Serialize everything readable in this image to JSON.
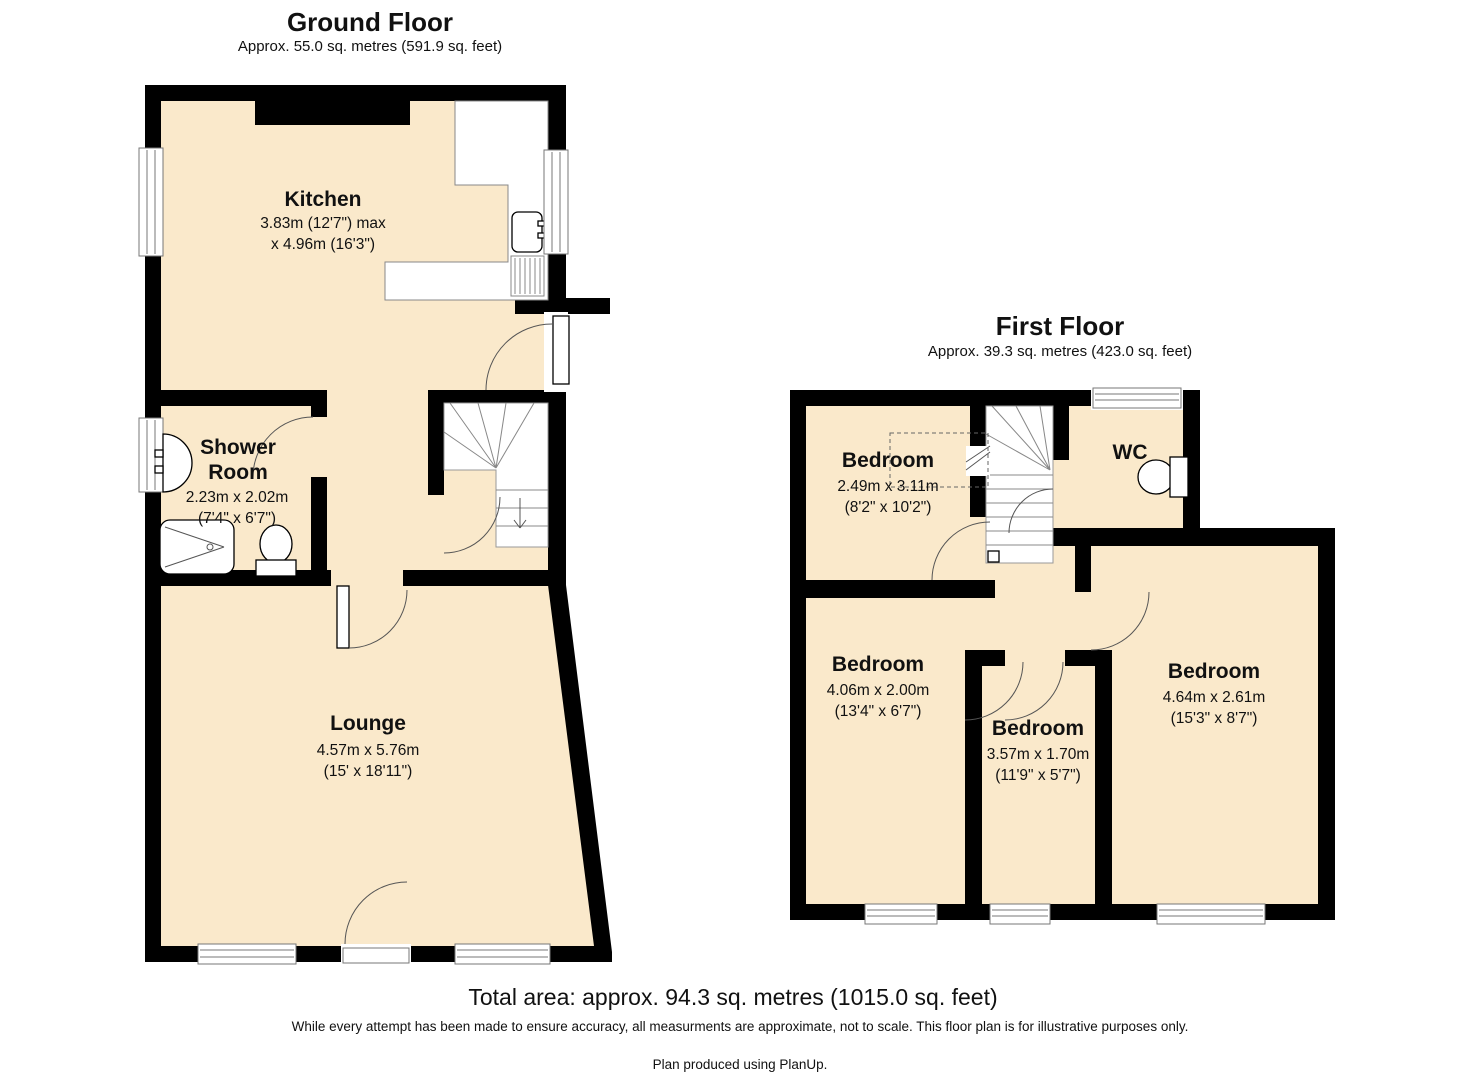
{
  "ground_floor": {
    "title": "Ground Floor",
    "area": "Approx. 55.0 sq. metres (591.9 sq. feet)",
    "rooms": {
      "kitchen": {
        "name": "Kitchen",
        "size_line1": "3.83m (12'7\") max",
        "size_line2": "x 4.96m (16'3\")"
      },
      "shower_room": {
        "name_line1": "Shower",
        "name_line2": "Room",
        "size_metric": "2.23m x 2.02m",
        "size_imperial": "(7'4\" x 6'7\")"
      },
      "lounge": {
        "name": "Lounge",
        "size_metric": "4.57m x 5.76m",
        "size_imperial": "(15' x 18'11\")"
      }
    }
  },
  "first_floor": {
    "title": "First Floor",
    "area": "Approx. 39.3 sq. metres (423.0 sq. feet)",
    "rooms": {
      "bedroom_top": {
        "name": "Bedroom",
        "size_metric": "2.49m x 3.11m",
        "size_imperial": "(8'2\" x 10'2\")"
      },
      "wc": {
        "name": "WC"
      },
      "bedroom_left": {
        "name": "Bedroom",
        "size_metric": "4.06m x 2.00m",
        "size_imperial": "(13'4\" x 6'7\")"
      },
      "bedroom_middle": {
        "name": "Bedroom",
        "size_metric": "3.57m x 1.70m",
        "size_imperial": "(11'9\" x 5'7\")"
      },
      "bedroom_right": {
        "name": "Bedroom",
        "size_metric": "4.64m x 2.61m",
        "size_imperial": "(15'3\" x 8'7\")"
      }
    }
  },
  "footer": {
    "total_area": "Total area: approx. 94.3 sq. metres (1015.0 sq. feet)",
    "disclaimer": "While every attempt has been made to ensure accuracy, all measurments are approximate, not to scale. This floor plan is for illustrative purposes only.",
    "credit": "Plan produced using PlanUp."
  },
  "colors": {
    "floor_fill": "#FAE9CB",
    "wall": "#000000",
    "page_bg": "#FFFFFF"
  }
}
